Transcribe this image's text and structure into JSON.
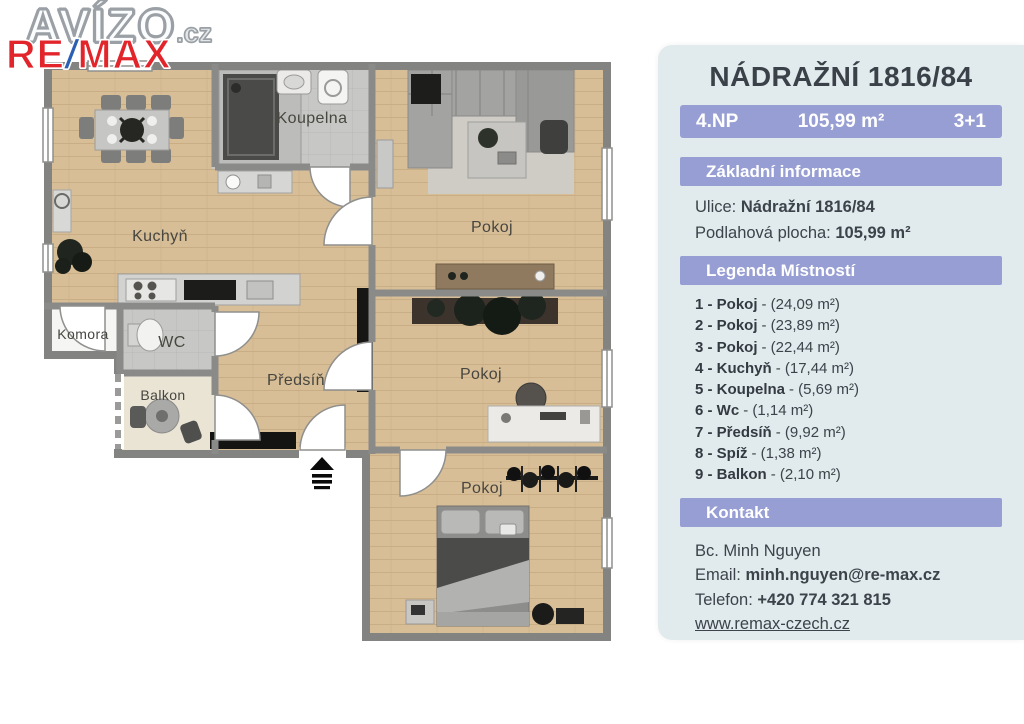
{
  "logo": {
    "avizo": "AVÍZO",
    "tld": ".cz",
    "re": "RE",
    "slash": "/",
    "max": "MAX"
  },
  "panel": {
    "title": "NÁDRAŽNÍ 1816/84",
    "summary": {
      "floor": "4.NP",
      "area": "105,99 m²",
      "layout": "3+1"
    },
    "basic_header": "Základní informace",
    "street_label": "Ulice:",
    "street_value": "Nádražní 1816/84",
    "area_label": "Podlahová plocha:",
    "area_value": "105,99 m²",
    "legend_header": "Legenda Místností",
    "legend": [
      {
        "bold": "1 - Pokoj",
        "rest": "- (24,09 m²)"
      },
      {
        "bold": "2 - Pokoj",
        "rest": "- (23,89 m²)"
      },
      {
        "bold": "3 - Pokoj",
        "rest": "- (22,44 m²)"
      },
      {
        "bold": "4 - Kuchyň",
        "rest": "- (17,44 m²)"
      },
      {
        "bold": "5 - Koupelna",
        "rest": "- (5,69 m²)"
      },
      {
        "bold": "6 - Wc",
        "rest": "- (1,14 m²)"
      },
      {
        "bold": "7 - Předsíň",
        "rest": "- (9,92 m²)"
      },
      {
        "bold": "8 - Spíž",
        "rest": "- (1,38 m²)"
      },
      {
        "bold": "9 - Balkon",
        "rest": "- (2,10 m²)"
      }
    ],
    "contact_header": "Kontakt",
    "contact": {
      "name": "Bc. Minh Nguyen",
      "email_label": "Email:",
      "email": "minh.nguyen@re-max.cz",
      "phone_label": "Telefon:",
      "phone": "+420 774 321 815",
      "web": "www.remax-czech.cz"
    }
  },
  "plan": {
    "rooms": {
      "kuchyn": "Kuchyň",
      "koupelna": "Koupelna",
      "pokoj1": "Pokoj",
      "pokoj2": "Pokoj",
      "pokoj3": "Pokoj",
      "wc": "WC",
      "komora": "Komora",
      "balkon": "Balkon",
      "predsin": "Předsíň"
    }
  },
  "colors": {
    "accent": "#979ed3",
    "panel_bg": "#e1ebed",
    "remax_red": "#e2242b",
    "remax_blue": "#2b5fb4",
    "wall": "#8a8a88",
    "wood": "#d8be97"
  }
}
